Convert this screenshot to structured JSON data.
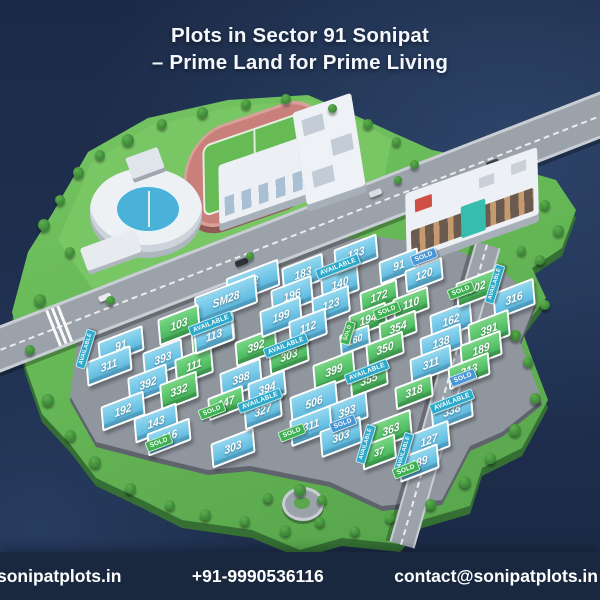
{
  "title": {
    "line1": "Plots in Sector 91 Sonipat",
    "line2": "– Prime Land for Prime Living"
  },
  "footer": {
    "website": "sonipatplots.in",
    "phone": "+91-9990536116",
    "email": "contact@sonipatplots.in"
  },
  "colors": {
    "background": "#1d2d4b",
    "plot_blue": "#6cc3e5",
    "plot_green": "#54c168",
    "tag_sold_green": "#3eb152",
    "tag_available_teal": "#2fa9c9",
    "tag_sold_blue": "#4796d6",
    "island_green": "#67b957",
    "road_gray": "#9ba2aa"
  },
  "map": {
    "plots": [
      {
        "label": "12",
        "x": 253,
        "y": 282,
        "w": 52,
        "h": 22,
        "color": "blue"
      },
      {
        "label": "SM28",
        "x": 226,
        "y": 300,
        "w": 62,
        "h": 24,
        "color": "blue"
      },
      {
        "label": "103",
        "x": 179,
        "y": 325,
        "w": 40,
        "h": 22,
        "color": "green"
      },
      {
        "label": "173",
        "x": 213,
        "y": 334,
        "w": 42,
        "h": 22,
        "color": "green"
      },
      {
        "label": "91",
        "x": 121,
        "y": 346,
        "w": 44,
        "h": 20,
        "color": "blue"
      },
      {
        "label": "311",
        "x": 109,
        "y": 366,
        "w": 44,
        "h": 20,
        "color": "blue"
      },
      {
        "label": "393",
        "x": 163,
        "y": 359,
        "w": 38,
        "h": 22,
        "color": "blue"
      },
      {
        "label": "111",
        "x": 194,
        "y": 366,
        "w": 36,
        "h": 22,
        "color": "green"
      },
      {
        "label": "392",
        "x": 148,
        "y": 384,
        "w": 38,
        "h": 22,
        "color": "blue"
      },
      {
        "label": "332",
        "x": 179,
        "y": 391,
        "w": 36,
        "h": 22,
        "color": "green"
      },
      {
        "label": "192",
        "x": 123,
        "y": 411,
        "w": 42,
        "h": 20,
        "color": "blue"
      },
      {
        "label": "143",
        "x": 156,
        "y": 423,
        "w": 42,
        "h": 20,
        "color": "blue"
      },
      {
        "label": "116",
        "x": 169,
        "y": 437,
        "w": 42,
        "h": 18,
        "color": "blue"
      },
      {
        "label": "303",
        "x": 233,
        "y": 448,
        "w": 42,
        "h": 20,
        "color": "blue"
      },
      {
        "label": "113",
        "x": 214,
        "y": 336,
        "w": 38,
        "h": 18,
        "color": "blue"
      },
      {
        "label": "392",
        "x": 256,
        "y": 347,
        "w": 40,
        "h": 20,
        "color": "green"
      },
      {
        "label": "303",
        "x": 289,
        "y": 356,
        "w": 38,
        "h": 20,
        "color": "green"
      },
      {
        "label": "398",
        "x": 241,
        "y": 379,
        "w": 40,
        "h": 22,
        "color": "blue"
      },
      {
        "label": "394",
        "x": 267,
        "y": 389,
        "w": 36,
        "h": 20,
        "color": "blue"
      },
      {
        "label": "327",
        "x": 263,
        "y": 411,
        "w": 36,
        "h": 20,
        "color": "blue"
      },
      {
        "label": "147",
        "x": 226,
        "y": 403,
        "w": 34,
        "h": 18,
        "color": "green"
      },
      {
        "label": "183",
        "x": 303,
        "y": 274,
        "w": 40,
        "h": 22,
        "color": "blue"
      },
      {
        "label": "140",
        "x": 340,
        "y": 284,
        "w": 36,
        "h": 22,
        "color": "blue"
      },
      {
        "label": "196",
        "x": 292,
        "y": 296,
        "w": 40,
        "h": 22,
        "color": "blue"
      },
      {
        "label": "123",
        "x": 331,
        "y": 305,
        "w": 36,
        "h": 22,
        "color": "blue"
      },
      {
        "label": "199",
        "x": 281,
        "y": 317,
        "w": 40,
        "h": 22,
        "color": "blue"
      },
      {
        "label": "112",
        "x": 308,
        "y": 328,
        "w": 36,
        "h": 22,
        "color": "blue"
      },
      {
        "label": "133",
        "x": 356,
        "y": 254,
        "w": 42,
        "h": 20,
        "color": "blue"
      },
      {
        "label": "91",
        "x": 399,
        "y": 266,
        "w": 38,
        "h": 18,
        "color": "blue"
      },
      {
        "label": "120",
        "x": 424,
        "y": 275,
        "w": 36,
        "h": 18,
        "color": "blue"
      },
      {
        "label": "172",
        "x": 379,
        "y": 297,
        "w": 36,
        "h": 18,
        "color": "green"
      },
      {
        "label": "110",
        "x": 411,
        "y": 304,
        "w": 34,
        "h": 18,
        "color": "green"
      },
      {
        "label": "194",
        "x": 368,
        "y": 320,
        "w": 36,
        "h": 18,
        "color": "green"
      },
      {
        "label": "354",
        "x": 398,
        "y": 328,
        "w": 36,
        "h": 18,
        "color": "green"
      },
      {
        "label": "160",
        "x": 355,
        "y": 340,
        "w": 28,
        "h": 16,
        "color": "blue"
      },
      {
        "label": "350",
        "x": 385,
        "y": 349,
        "w": 36,
        "h": 18,
        "color": "green"
      },
      {
        "label": "162",
        "x": 451,
        "y": 321,
        "w": 40,
        "h": 22,
        "color": "blue"
      },
      {
        "label": "138",
        "x": 441,
        "y": 343,
        "w": 40,
        "h": 20,
        "color": "blue"
      },
      {
        "label": "311",
        "x": 431,
        "y": 364,
        "w": 40,
        "h": 20,
        "color": "blue"
      },
      {
        "label": "302",
        "x": 477,
        "y": 288,
        "w": 40,
        "h": 20,
        "color": "green"
      },
      {
        "label": "316",
        "x": 514,
        "y": 299,
        "w": 40,
        "h": 22,
        "color": "blue"
      },
      {
        "label": "391",
        "x": 489,
        "y": 330,
        "w": 40,
        "h": 22,
        "color": "green"
      },
      {
        "label": "189",
        "x": 481,
        "y": 350,
        "w": 40,
        "h": 20,
        "color": "green"
      },
      {
        "label": "313",
        "x": 469,
        "y": 371,
        "w": 40,
        "h": 18,
        "color": "green"
      },
      {
        "label": "318",
        "x": 414,
        "y": 392,
        "w": 36,
        "h": 18,
        "color": "green"
      },
      {
        "label": "338",
        "x": 452,
        "y": 411,
        "w": 40,
        "h": 22,
        "color": "blue"
      },
      {
        "label": "399",
        "x": 334,
        "y": 371,
        "w": 40,
        "h": 22,
        "color": "green"
      },
      {
        "label": "355",
        "x": 369,
        "y": 380,
        "w": 36,
        "h": 18,
        "color": "green"
      },
      {
        "label": "506",
        "x": 314,
        "y": 403,
        "w": 46,
        "h": 24,
        "color": "blue"
      },
      {
        "label": "393",
        "x": 347,
        "y": 412,
        "w": 40,
        "h": 22,
        "color": "blue"
      },
      {
        "label": "311",
        "x": 311,
        "y": 426,
        "w": 40,
        "h": 22,
        "color": "blue"
      },
      {
        "label": "303",
        "x": 341,
        "y": 437,
        "w": 40,
        "h": 22,
        "color": "blue"
      },
      {
        "label": "363",
        "x": 391,
        "y": 430,
        "w": 40,
        "h": 22,
        "color": "green"
      },
      {
        "label": "37",
        "x": 379,
        "y": 452,
        "w": 32,
        "h": 20,
        "color": "green"
      },
      {
        "label": "127",
        "x": 429,
        "y": 441,
        "w": 40,
        "h": 22,
        "color": "blue"
      },
      {
        "label": "189",
        "x": 419,
        "y": 463,
        "w": 38,
        "h": 20,
        "color": "blue"
      }
    ],
    "tags": [
      {
        "label": "AVAILABLE",
        "x": 211,
        "y": 324,
        "style": "avail",
        "vertical": false
      },
      {
        "label": "AVAILABLE",
        "x": 86,
        "y": 349,
        "style": "avail",
        "vertical": true
      },
      {
        "label": "SOLD",
        "x": 159,
        "y": 443,
        "style": "sold",
        "vertical": false
      },
      {
        "label": "AVAILABLE",
        "x": 286,
        "y": 346,
        "style": "avail",
        "vertical": false
      },
      {
        "label": "AVAILABLE",
        "x": 260,
        "y": 401,
        "style": "avail",
        "vertical": false
      },
      {
        "label": "SOLD",
        "x": 212,
        "y": 411,
        "style": "sold",
        "vertical": false
      },
      {
        "label": "AVAILABLE",
        "x": 338,
        "y": 267,
        "style": "avail",
        "vertical": false
      },
      {
        "label": "SOLD",
        "x": 424,
        "y": 257,
        "style": "soldb",
        "vertical": false
      },
      {
        "label": "SOLD",
        "x": 387,
        "y": 311,
        "style": "sold",
        "vertical": false
      },
      {
        "label": "SOLD",
        "x": 348,
        "y": 333,
        "style": "sold",
        "vertical": true
      },
      {
        "label": "SOLD",
        "x": 461,
        "y": 291,
        "style": "sold",
        "vertical": false
      },
      {
        "label": "AVAILABLE",
        "x": 495,
        "y": 284,
        "style": "avail",
        "vertical": true
      },
      {
        "label": "SOLD",
        "x": 463,
        "y": 378,
        "style": "soldb",
        "vertical": false
      },
      {
        "label": "AVAILABLE",
        "x": 452,
        "y": 402,
        "style": "avail",
        "vertical": false
      },
      {
        "label": "AVAILABLE",
        "x": 367,
        "y": 372,
        "style": "avail",
        "vertical": false
      },
      {
        "label": "SOLD",
        "x": 343,
        "y": 424,
        "style": "soldb",
        "vertical": false
      },
      {
        "label": "SOLD",
        "x": 292,
        "y": 433,
        "style": "sold",
        "vertical": false
      },
      {
        "label": "AVAILABLE",
        "x": 366,
        "y": 444,
        "style": "avail",
        "vertical": true
      },
      {
        "label": "AVAILABLE",
        "x": 404,
        "y": 452,
        "style": "avail",
        "vertical": true
      },
      {
        "label": "SOLD",
        "x": 406,
        "y": 470,
        "style": "sold",
        "vertical": false
      }
    ]
  }
}
